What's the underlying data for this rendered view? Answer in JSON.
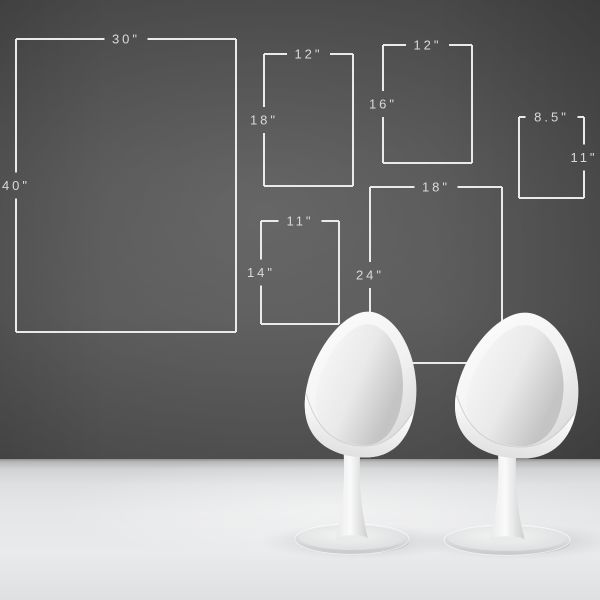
{
  "scene": {
    "kind": "wall-frame-size-guide-with-egg-chairs",
    "wall_color": "#545454",
    "line_color": "#eaeaea",
    "label_color": "#d9d9d9",
    "floor_color": "#e6e7e8",
    "chair_color": "#f4f4f4"
  },
  "frames": [
    {
      "id": "30x40",
      "width_label": "30\"",
      "height_label": "40\"",
      "x": 16,
      "y": 39,
      "w": 220,
      "h": 293,
      "height_label_side": "left"
    },
    {
      "id": "12x18",
      "width_label": "12\"",
      "height_label": "18\"",
      "x": 264,
      "y": 54,
      "w": 89,
      "h": 132,
      "height_label_side": "left"
    },
    {
      "id": "12x16",
      "width_label": "12\"",
      "height_label": "16\"",
      "x": 383,
      "y": 45,
      "w": 89,
      "h": 118,
      "height_label_side": "left"
    },
    {
      "id": "8.5x11",
      "width_label": "8.5\"",
      "height_label": "11\"",
      "x": 519,
      "y": 117,
      "w": 65,
      "h": 81,
      "height_label_side": "right"
    },
    {
      "id": "11x14",
      "width_label": "11\"",
      "height_label": "14\"",
      "x": 261,
      "y": 221,
      "w": 78,
      "h": 103,
      "height_label_side": "left"
    },
    {
      "id": "18x24",
      "width_label": "18\"",
      "height_label": "24\"",
      "x": 370,
      "y": 187,
      "w": 132,
      "h": 176,
      "height_label_side": "left"
    }
  ],
  "chairs": [
    {
      "id": "left",
      "transform": "translate(293,311) scale(0.95)"
    },
    {
      "id": "right",
      "transform": "translate(442,312) scale(1.05,0.95)"
    }
  ],
  "floor_shadows": [
    {
      "cx": 358,
      "cy": 542,
      "rx": 98,
      "ry": 18
    },
    {
      "cx": 516,
      "cy": 542,
      "rx": 102,
      "ry": 18
    }
  ]
}
